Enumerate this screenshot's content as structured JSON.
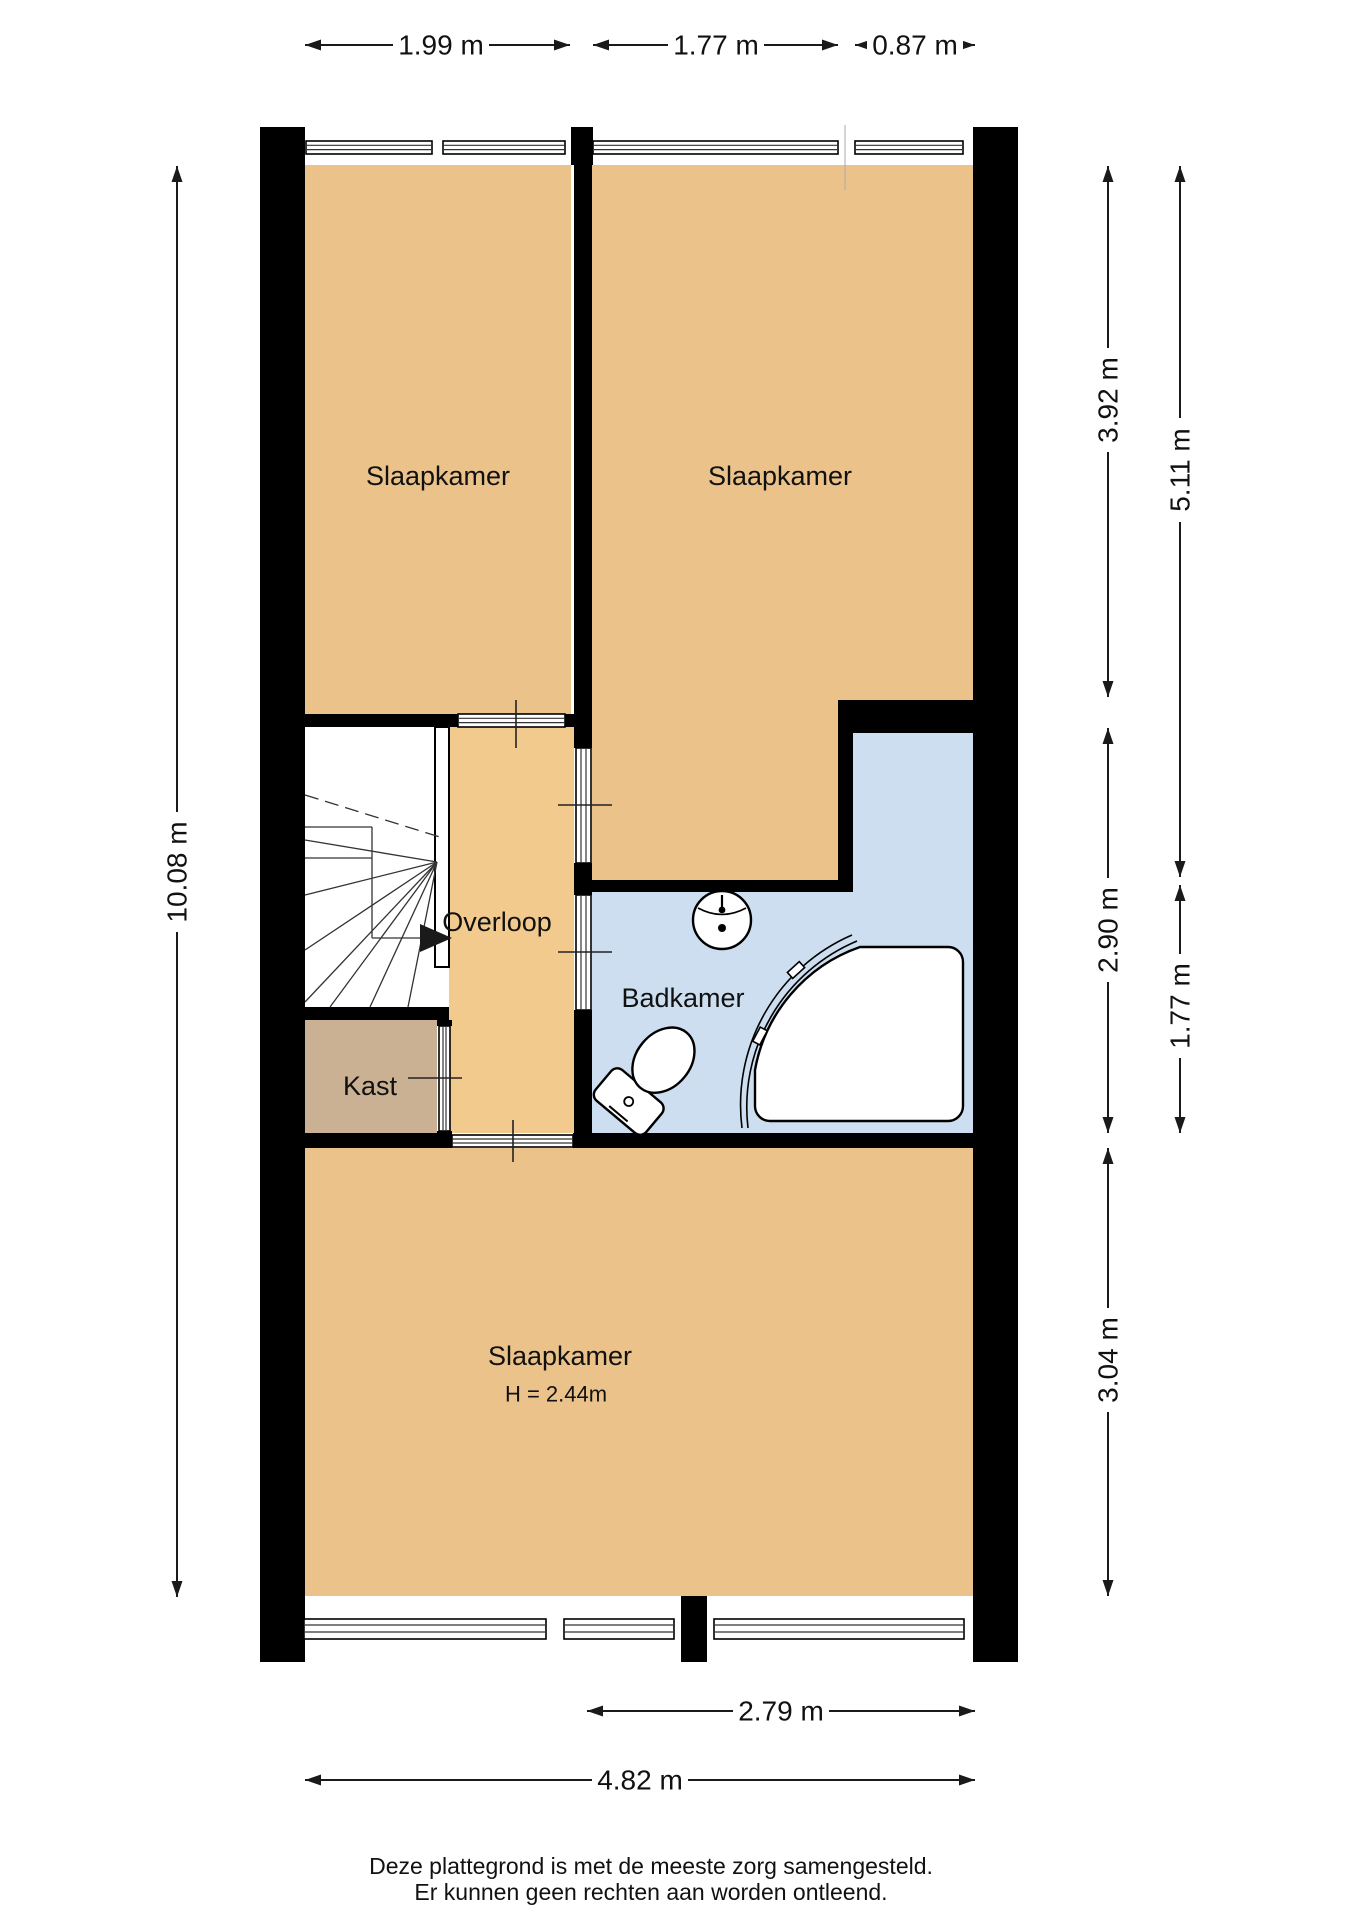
{
  "plan": {
    "title_rooms": "First floor plan (Dutch labels)",
    "rooms": [
      {
        "name": "slaapkamer-links",
        "label": "Slaapkamer"
      },
      {
        "name": "slaapkamer-rechts",
        "label": "Slaapkamer"
      },
      {
        "name": "overloop",
        "label": "Overloop"
      },
      {
        "name": "badkamer",
        "label": "Badkamer"
      },
      {
        "name": "kast",
        "label": "Kast"
      },
      {
        "name": "slaapkamer-onder",
        "label": "Slaapkamer",
        "height_note": "H = 2.44m"
      }
    ],
    "fixtures": [
      "stairs",
      "toilet",
      "sink",
      "shower"
    ]
  },
  "dimensions": {
    "top": [
      {
        "label": "1.99 m"
      },
      {
        "label": "1.77 m"
      },
      {
        "label": "0.87 m"
      }
    ],
    "left": [
      {
        "label": "10.08 m"
      }
    ],
    "right": [
      {
        "label": "3.92 m"
      },
      {
        "label": "5.11 m"
      },
      {
        "label": "2.90 m"
      },
      {
        "label": "1.77 m"
      },
      {
        "label": "3.04 m"
      }
    ],
    "bottom": [
      {
        "label": "2.79 m"
      },
      {
        "label": "4.82 m"
      }
    ]
  },
  "footer": {
    "line1": "Deze plattegrond is met de meeste zorg samengesteld.",
    "line2": "Er kunnen geen rechten aan worden ontleend."
  },
  "colors": {
    "room": "#EAC28A",
    "hallway": "#F2CA8E",
    "closet": "#CBB193",
    "bathroom": "#CCDEEF",
    "wall": "#000000",
    "background": "#FFFFFF"
  }
}
